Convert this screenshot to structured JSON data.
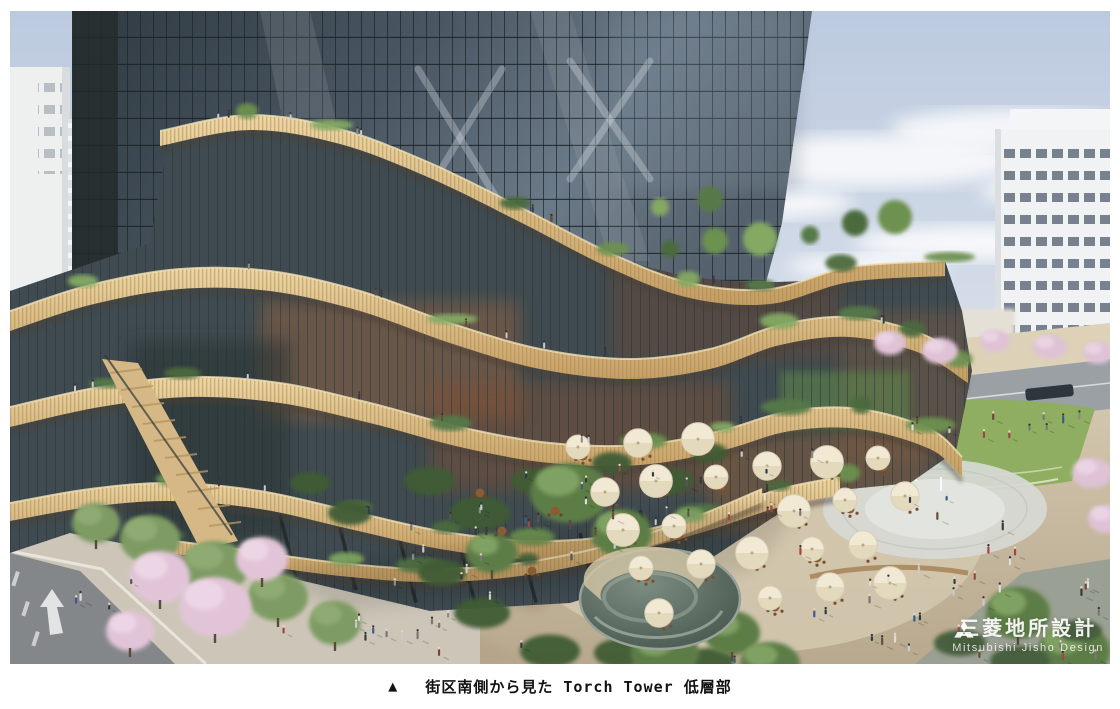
{
  "figure": {
    "watermark": {
      "logo_icon": "mitsubishi-three-diamonds-icon",
      "company_jp": "三菱地所設計",
      "company_en": "Mitsubishi Jisho Design"
    }
  },
  "caption": {
    "marker": "▲",
    "text": "街区南側から見た Torch Tower 低層部"
  },
  "palette": {
    "sky_top": "#bccadf",
    "sky_bottom": "#e9ebee",
    "tower_glass_dark": "#2f3a41",
    "tower_glass_light": "#5d6a76",
    "wood_light": "#ecd6a4",
    "wood_dark": "#c49e63",
    "foliage": "#6f9150",
    "blossom": "#e5c9db",
    "plaza_light": "#d6cab2",
    "plaza_dark": "#b8a98e",
    "water_light": "#7c8d82",
    "water_dark": "#46544c",
    "road": "#84878a",
    "caption_text": "#111111",
    "watermark_text": "#ffffff"
  }
}
